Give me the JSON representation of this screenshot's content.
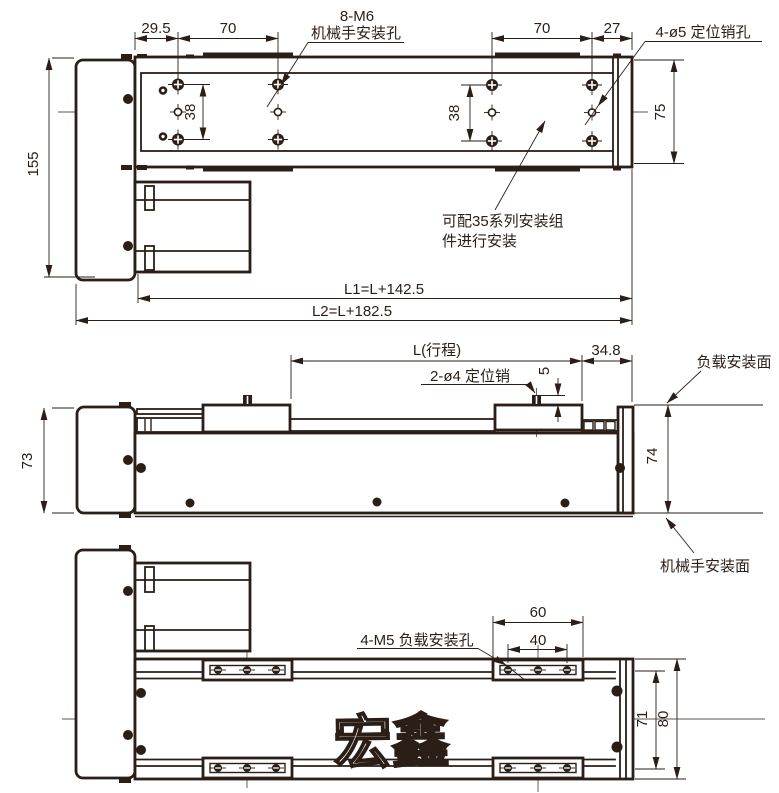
{
  "colors": {
    "ink": "#2a1e16",
    "background": "#ffffff"
  },
  "top_view": {
    "dim_29_5": "29.5",
    "dim_70_left": "70",
    "dim_70_right": "70",
    "dim_27": "27",
    "dim_38_left": "38",
    "dim_38_right": "38",
    "dim_75": "75",
    "dim_155": "155",
    "dim_l1": "L1=L+142.5",
    "dim_l2": "L2=L+182.5",
    "label_m6": "8-M6",
    "label_m6_sub": "机械手安装孔",
    "label_pin_holes": "4-ø5 定位销孔",
    "note_line1": "可配35系列安装组",
    "note_line2": "件进行安装"
  },
  "side_view": {
    "dim_stroke": "L(行程)",
    "dim_34_8": "34.8",
    "dim_5": "5",
    "dim_73": "73",
    "dim_74": "74",
    "label_pins": "2-ø4 定位销",
    "label_load_surface": "负载安装面",
    "label_robot_surface": "机械手安装面"
  },
  "bottom_view": {
    "dim_60": "60",
    "dim_40": "40",
    "dim_71": "71",
    "dim_80": "80",
    "label_load_holes": "4-M5 负载安装孔",
    "logo": "宏鑫"
  }
}
